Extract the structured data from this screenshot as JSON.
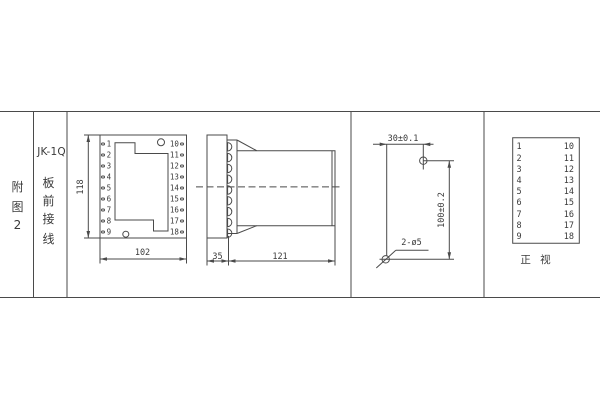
{
  "sidebar": {
    "figure_label": [
      "附",
      "图",
      "2"
    ],
    "model": "JK-1Q",
    "wiring_label": [
      "板",
      "前",
      "接",
      "线"
    ]
  },
  "front_view": {
    "left_terminals": [
      "1",
      "2",
      "3",
      "4",
      "5",
      "6",
      "7",
      "8",
      "9"
    ],
    "right_terminals": [
      "10",
      "11",
      "12",
      "13",
      "14",
      "15",
      "16",
      "17",
      "18"
    ],
    "dim_height": "118",
    "dim_width": "102"
  },
  "side_view": {
    "dim_front_depth": "35",
    "dim_case_depth": "121"
  },
  "drill_plan": {
    "dim_horizontal": "30±0.1",
    "dim_vertical": "100±0.2",
    "holes_label": "2-ø5"
  },
  "terminal_table": {
    "rows": [
      [
        "1",
        "10"
      ],
      [
        "2",
        "11"
      ],
      [
        "3",
        "12"
      ],
      [
        "4",
        "13"
      ],
      [
        "5",
        "14"
      ],
      [
        "6",
        "15"
      ],
      [
        "7",
        "16"
      ],
      [
        "8",
        "17"
      ],
      [
        "9",
        "18"
      ]
    ],
    "caption": "正 视"
  },
  "colors": {
    "line": "#4a4a4a",
    "text": "#3a3a3a",
    "background": "#ffffff"
  }
}
